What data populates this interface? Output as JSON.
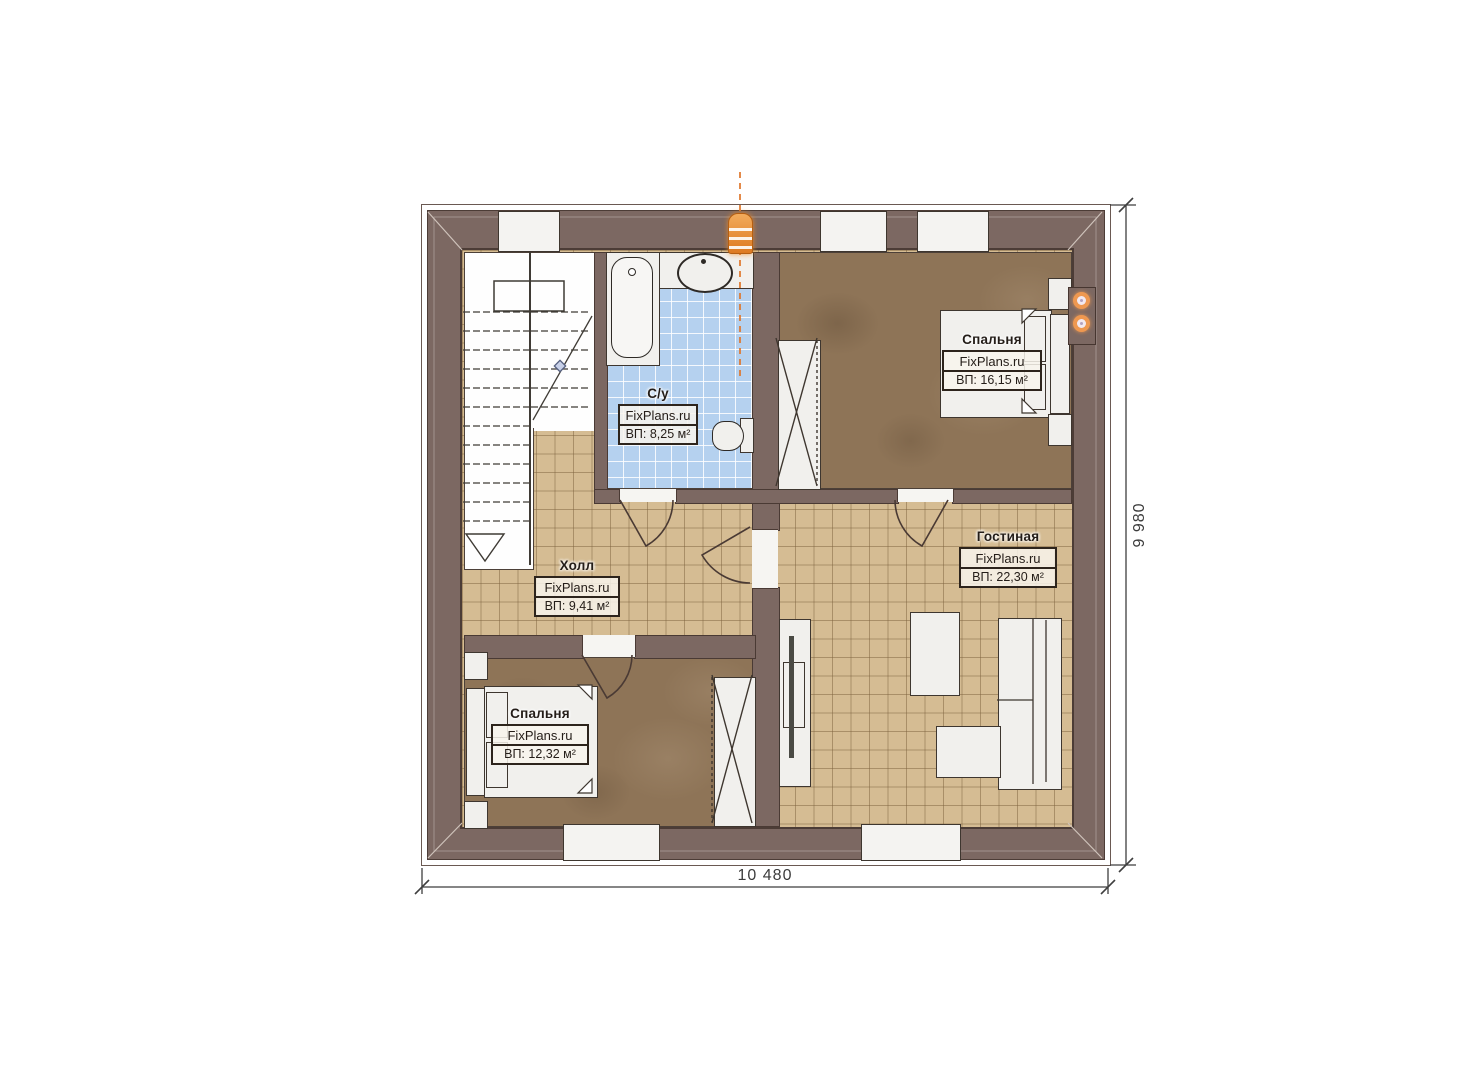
{
  "watermark": "FixPlans.ru",
  "rooms": [
    {
      "id": "bathroom",
      "name": "С/у",
      "area": "ВП: 8,25 м²"
    },
    {
      "id": "bedroom-top-right",
      "name": "Спальня",
      "area": "ВП: 16,15 м²"
    },
    {
      "id": "hall",
      "name": "Холл",
      "area": "ВП: 9,41 м²"
    },
    {
      "id": "living-room",
      "name": "Гостиная",
      "area": "ВП: 22,30 м²"
    },
    {
      "id": "bedroom-bottom-left",
      "name": "Спальня",
      "area": "ВП: 12,32 м²"
    }
  ],
  "dimensions": {
    "width_label": "10 480",
    "height_label": "9 980"
  },
  "colors": {
    "wall": "#7c6862",
    "floor_tile": "#d5bc93",
    "carpet": "#8e7457",
    "bath_tile": "#b5d1ef",
    "accent_orange": "#e0762a"
  }
}
